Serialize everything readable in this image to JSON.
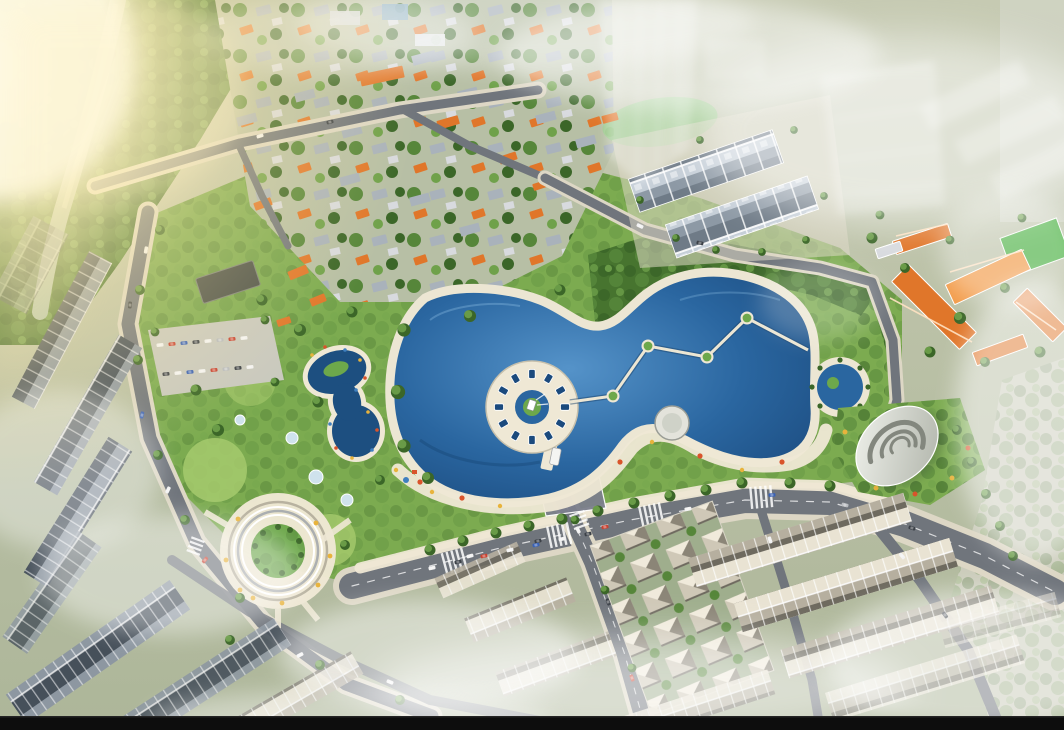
{
  "scene": {
    "type": "aerial-3d-architectural-rendering",
    "subject": "urban master plan with central lake park, townhouse blocks and boulevards",
    "time_of_day": "daytime, strong sun flare from upper left, mist patches",
    "landmarks": [
      {
        "id": "river-canal",
        "desc": "tree-lined canal running down the upper-left"
      },
      {
        "id": "existing-town",
        "desc": "low-rise houses with orange and grey roofs among dense trees, top band"
      },
      {
        "id": "central-lake",
        "desc": "large two-lobed deep blue lake"
      },
      {
        "id": "fountain-plaza",
        "desc": "circular white plaza ring with radial dark slots inside the lake"
      },
      {
        "id": "floating-bridges",
        "desc": "zigzag footbridges linking four small round green islands"
      },
      {
        "id": "lazy-river-pool",
        "desc": "figure-eight swimming pool with colorful rim, west of lake"
      },
      {
        "id": "amphitheater-park",
        "desc": "circular stepped lawn park, lower left"
      },
      {
        "id": "round-pond",
        "desc": "circular palm-rimmed fountain pond east of the lake"
      },
      {
        "id": "shell-pavilion",
        "desc": "white nautilus-shell roofed building in east garden"
      },
      {
        "id": "school-complex",
        "desc": "orange gable-roof buildings with bright green sports field, upper right"
      },
      {
        "id": "shophouse-rows",
        "desc": "rows of grey three-storey townhouses, top center and bottom"
      },
      {
        "id": "villa-grid",
        "desc": "grid blocks of detached hip-roof villas, bottom center"
      },
      {
        "id": "main-avenue",
        "desc": "wide boulevard with cars, crosswalks and street trees below the park"
      },
      {
        "id": "ghost-towers",
        "desc": "translucent white future-phase tower slabs, top"
      },
      {
        "id": "parking-lot",
        "desc": "surface car park with colorful car rows, mid left"
      },
      {
        "id": "fog",
        "desc": "white mist drifting over bottom and top edges"
      },
      {
        "id": "letterbox",
        "desc": "black horizontal bar across the very bottom"
      }
    ]
  },
  "colors": {
    "ground": "#b7bfa5",
    "forest": "#47742f",
    "tree_dark": "#3b6628",
    "tree_mid": "#56863a",
    "tree_light": "#6fa14a",
    "lawn": "#a6ca6d",
    "park_green": "#7cab50",
    "field_green": "#43b03c",
    "pond_green": "#9ecb8f",
    "river": "#a9bfae",
    "lake": "#2a66a0",
    "lake_deep": "#1b4a7d",
    "lake_light": "#5593c9",
    "pool": "#1d4f80",
    "shore": "#ece6d3",
    "plaza": "#efe8d5",
    "road": "#70757c",
    "road_plaza": "#7c7f8d",
    "sidewalk": "#ddd7c5",
    "marking": "#ffffff",
    "roof_orange": "#e0762a",
    "roof_orange_lit": "#f29a47",
    "roof_grey": "#a9b2bb",
    "roof_dark": "#46505a",
    "roof_dark_lit": "#8d97a1",
    "roof_light": "#b6af9f",
    "roof_light_lit": "#e9e3d3",
    "villa_roof": "#cfc8b7",
    "villa_roof_lit": "#f0eadb",
    "facade": "#c6cfd8",
    "shell_light": "#f2f4ee",
    "shell_dark": "#aeb2a8",
    "shell_ridge": "#83877e",
    "island_green": "#6da84b",
    "flower_red": "#d9542b",
    "flower_yellow": "#e8b33c",
    "flower_blue": "#3f7fbf",
    "car_white": "#f2f2f2",
    "car_red": "#c84332",
    "car_blue": "#3a62b5",
    "car_dark": "#3c4148",
    "sun_glow": "#ffe9a8",
    "sun_core": "#fffbe8",
    "haze": "#ffffff",
    "black_bar": "#0d0d0d"
  }
}
